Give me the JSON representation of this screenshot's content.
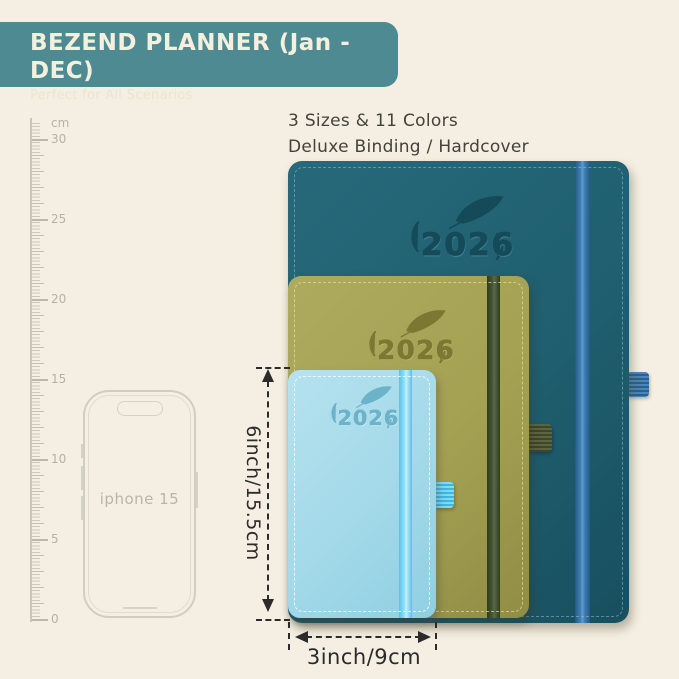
{
  "banner": {
    "title": "BEZEND PLANNER (Jan - DEC)",
    "subtitle": "Perfect for All Scenarios"
  },
  "features": {
    "line1": "3 Sizes & 11 Colors",
    "line2": "Deluxe Binding / Hardcover"
  },
  "ruler": {
    "unit": "cm",
    "labels": [
      "30",
      "25",
      "20",
      "15",
      "10",
      "5",
      "0"
    ]
  },
  "phone": {
    "label": "iphone 15"
  },
  "planners": {
    "large": {
      "year": "2026",
      "cover_color": "#1f5f6f",
      "band_color": "#3d7db2"
    },
    "medium": {
      "year": "2026",
      "cover_color": "#a5a153",
      "band_color": "#465536"
    },
    "small": {
      "year": "2026",
      "cover_color": "#a3d9e9",
      "band_color": "#7dd2ef"
    }
  },
  "dimensions": {
    "height_label": "6inch/15.5cm",
    "width_label": "3inch/9cm"
  },
  "palette": {
    "background": "#f4efe2",
    "banner_bg": "#4e8a92",
    "text_dark": "#42423b",
    "annotation": "#2b2b2b"
  }
}
